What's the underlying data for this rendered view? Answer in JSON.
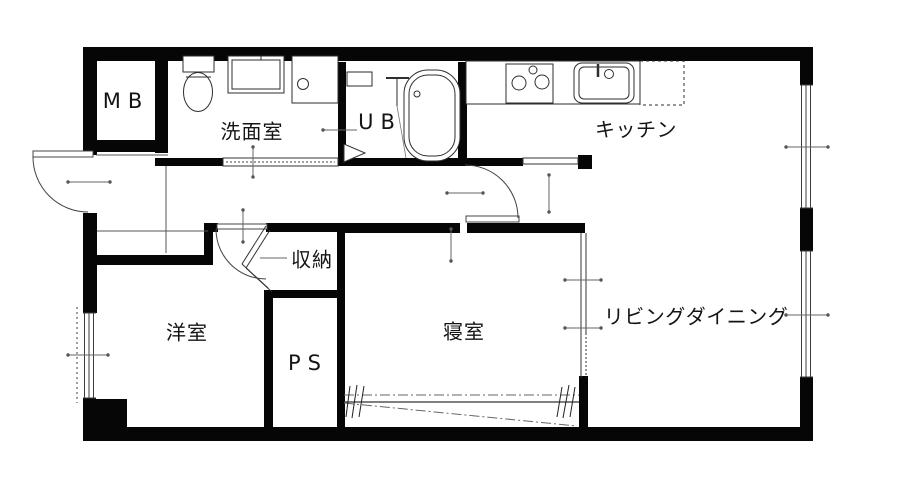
{
  "floorplan": {
    "type": "apartment-floor-plan",
    "rooms": [
      {
        "id": "mb",
        "label": "MB"
      },
      {
        "id": "washroom",
        "label": "洗面室"
      },
      {
        "id": "unit-bath",
        "label": "UB"
      },
      {
        "id": "kitchen",
        "label": "キッチン"
      },
      {
        "id": "storage",
        "label": "収納"
      },
      {
        "id": "western-room",
        "label": "洋室"
      },
      {
        "id": "pipe-space",
        "label": "PS"
      },
      {
        "id": "bedroom",
        "label": "寝室"
      },
      {
        "id": "living-dining",
        "label": "リビングダイニング"
      }
    ],
    "colors": {
      "wall": "#000000",
      "background": "#ffffff",
      "thin_line": "#555555"
    }
  }
}
